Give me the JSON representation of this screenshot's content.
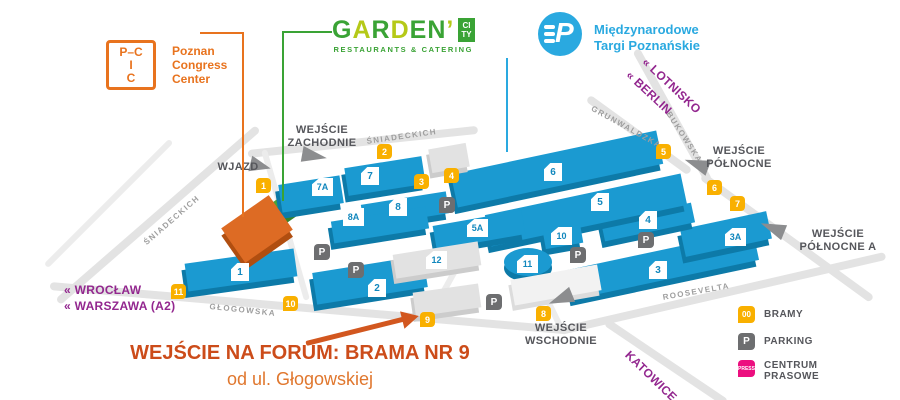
{
  "header": {
    "pcc": {
      "box_lines": [
        "P–C",
        "I",
        "C"
      ],
      "name_lines": [
        "Poznan",
        "Congress",
        "Center"
      ]
    },
    "garden": {
      "letters": [
        "G",
        "A",
        "R",
        "D",
        "E",
        "N",
        "’"
      ],
      "city": [
        "CI",
        "TY"
      ],
      "subtitle": "RESTAURANTS & CATERING"
    },
    "mtp": {
      "monogram": "P",
      "name_lines": [
        "Międzynarodowe",
        "Targi Poznańskie"
      ]
    }
  },
  "map": {
    "entrances": [
      {
        "id": "zachodnie",
        "lines": [
          "WEJŚCIE",
          "ZACHODNIE"
        ]
      },
      {
        "id": "wjazd",
        "lines": [
          "WJAZD"
        ]
      },
      {
        "id": "polnocne",
        "lines": [
          "WEJŚCIE",
          "PÓŁNOCNE"
        ]
      },
      {
        "id": "polnocne-a",
        "lines": [
          "WEJŚCIE",
          "PÓŁNOCNE A"
        ]
      },
      {
        "id": "wschodnie",
        "lines": [
          "WEJŚCIE",
          "WSCHODNIE"
        ]
      }
    ],
    "streets": [
      "ŚNIADECKICH",
      "ŚNIADECKICH",
      "GRUNWALDZKA",
      "BUKOWSKA",
      "GŁOGOWSKA",
      "ROOSEVELTA"
    ],
    "directions": [
      "« WROCŁAW",
      "« WARSZAWA (A2)",
      "« LOTNISKO",
      "« BERLIN",
      "KATOWICE »"
    ],
    "buildings": [
      "1",
      "2",
      "3",
      "3A",
      "4",
      "5",
      "5A",
      "6",
      "7",
      "7A",
      "8",
      "8A",
      "10",
      "11",
      "12"
    ],
    "gates": [
      "1",
      "2",
      "3",
      "4",
      "5",
      "6",
      "7",
      "8",
      "9",
      "10",
      "11"
    ],
    "parking_letter": "P"
  },
  "legend": {
    "items": [
      {
        "icon_text": "00",
        "label_lines": [
          "BRAMY"
        ]
      },
      {
        "icon_text": "P",
        "label_lines": [
          "PARKING"
        ]
      },
      {
        "icon_text": "PRESS",
        "label_lines": [
          "CENTRUM",
          "PRASOWE"
        ]
      }
    ]
  },
  "annotation": {
    "headline": "WEJŚCIE NA FORUM: BRAMA NR 9",
    "subline": "od ul. Głogowskiej"
  },
  "colors": {
    "brand_orange": "#e8731e",
    "mtp_blue": "#2aa9e0",
    "garden_green": "#3aa335",
    "gate_yellow": "#f9b000",
    "press_pink": "#ec0f7f",
    "building_blue": "#1b9ad1",
    "building_side_blue": "#0d7aa8",
    "road_gray": "#e3e3e3",
    "direction_purple": "#93278f",
    "annotation_orange": "#cc4c1a"
  }
}
